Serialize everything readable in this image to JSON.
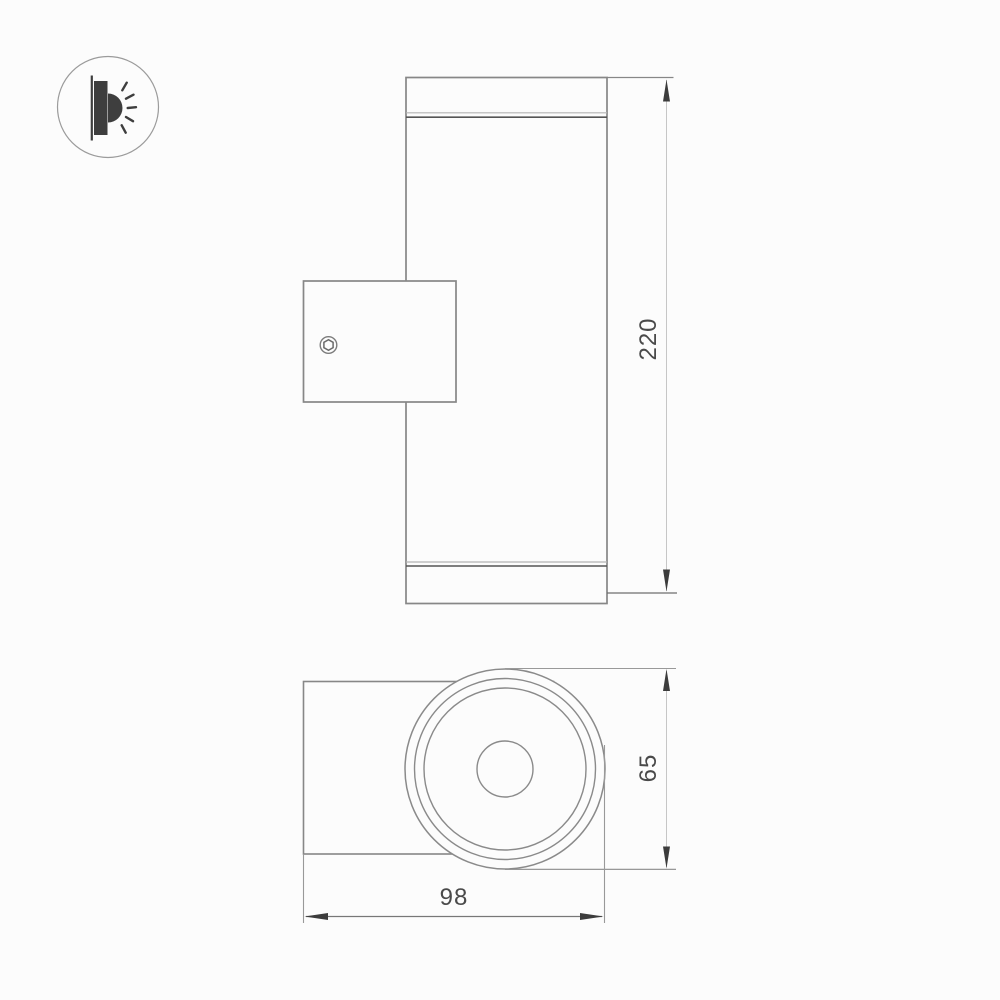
{
  "drawing": {
    "type": "technical-dimension-drawing",
    "subject": "cylindrical wall-mounted luminaire shown in side view and front view",
    "dimensions": {
      "height": {
        "value": "220"
      },
      "diameter": {
        "value": "65"
      },
      "depth": {
        "value": "98"
      }
    },
    "icons": {
      "wall_light": "wall-light-icon",
      "screw": "screw-head-icon",
      "arrows": [
        "arrow-up-icon",
        "arrow-down-icon",
        "arrow-left-icon",
        "arrow-right-icon"
      ]
    },
    "colors": {
      "background": "#fcfcfc",
      "outline": "#878787",
      "dark_accent_line": "#555555",
      "light_accent_line": "#b3b3b3",
      "dimension_line": "#c6c6c6",
      "extension_line": "#999999",
      "arrow": "#3c3c3c",
      "label_text": "#4a4a4a",
      "icon_fill": "#3e3e3e"
    }
  }
}
